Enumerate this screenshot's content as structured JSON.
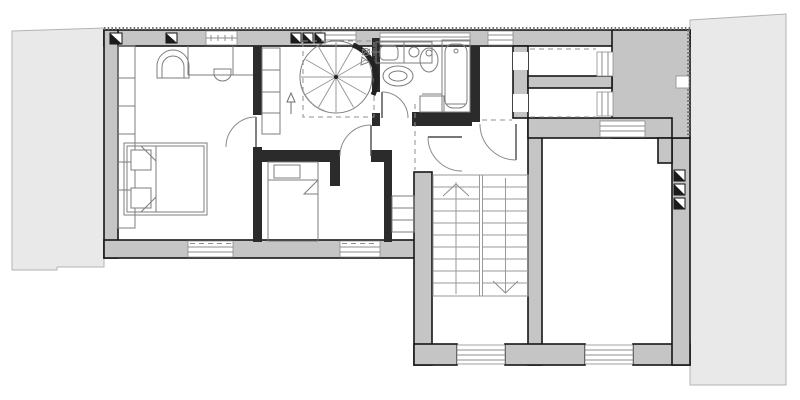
{
  "title": "attic-floor-plan",
  "visible_text": [],
  "colors": {
    "background": "#ffffff",
    "wall_fill": "#c5c5c5",
    "wall_stroke": "#161616",
    "partition_fill": "#2b2b2b",
    "adjacent_fill": "#e9e9e9",
    "adjacent_stroke": "#b3b3b3",
    "furniture_stroke": "#7d7d7d",
    "window_fill": "#ffffff",
    "hatch": "#6e6e6e"
  },
  "plan": {
    "type": "architectural-floor-plan",
    "adjacent_structures": [
      {
        "name": "adjacent-roof-left",
        "side": "west"
      },
      {
        "name": "adjacent-building-right",
        "side": "east"
      }
    ],
    "rooms": [
      {
        "name": "bedroom-1",
        "fixtures": [
          "double-bed",
          "two-pillows",
          "closet-shelves-west-wall",
          "arched-niche",
          "wall-mounted-basin",
          "south-window",
          "door-to-hall"
        ]
      },
      {
        "name": "bedroom-2",
        "fixtures": [
          "single-bed",
          "pillow",
          "closet-strip",
          "south-window",
          "door-to-hall"
        ]
      },
      {
        "name": "hall-with-spiral-stair",
        "fixtures": [
          "spiral-staircase-12-treads",
          "dashed-stair-opening",
          "direction-arrow",
          "hall-wardrobe",
          "three-roof-skylights"
        ]
      },
      {
        "name": "bathroom",
        "fixtures": [
          "washbasin-counter",
          "faucet-valves",
          "toilet",
          "bidet",
          "bathtub",
          "cabinet",
          "door"
        ]
      },
      {
        "name": "hallway-east",
        "fixtures": [
          "door-to-stair-hall",
          "door-arc-east",
          "clerestory-window"
        ]
      },
      {
        "name": "storage-room-north-1",
        "fixtures": [
          "roofline-dashed",
          "east-window",
          "west-opening"
        ]
      },
      {
        "name": "storage-room-north-2",
        "fixtures": [
          "roofline-dashed",
          "east-window",
          "west-opening"
        ]
      },
      {
        "name": "stairwell",
        "fixtures": [
          "u-shaped-stair-two-flights",
          "up-chevron",
          "down-chevron",
          "south-window",
          "landing"
        ]
      },
      {
        "name": "large-room-east",
        "fixtures": [
          "three-skylights-east-wall",
          "south-window",
          "north-opening",
          "pilaster"
        ]
      }
    ],
    "counts": {
      "skylight_symbols_top_wall": 5,
      "skylight_symbols_east_wall": 3,
      "door_swing_arcs": 5,
      "windows_south": 4,
      "spiral_stair_treads": 12,
      "straight_stair_treads_per_flight": 10
    }
  }
}
